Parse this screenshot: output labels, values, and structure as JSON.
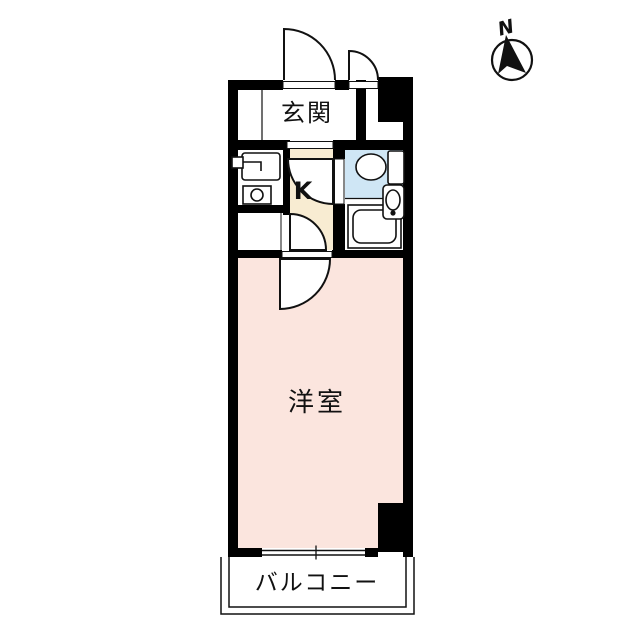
{
  "compass": {
    "north_label": "N"
  },
  "rooms": {
    "genkan": {
      "label": "玄関"
    },
    "kitchen": {
      "label": "K"
    },
    "western_room": {
      "label": "洋室"
    },
    "balcony": {
      "label": "バルコニー"
    }
  },
  "colors": {
    "wall": "#000000",
    "kitchen_fill": "#f8ecd2",
    "western_room_fill": "#fbe5de",
    "bathroom_fill": "#cfe6f5",
    "line": "#111111",
    "background": "#ffffff"
  }
}
